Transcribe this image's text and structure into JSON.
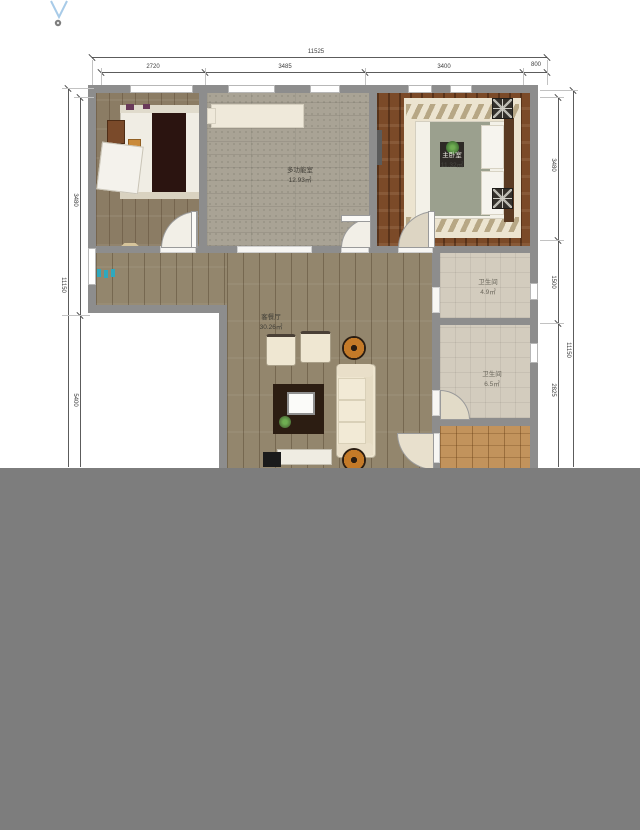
{
  "dimensions": {
    "top": {
      "total": "11525",
      "segments": [
        "2720",
        "3485",
        "3400",
        "800"
      ]
    },
    "left": {
      "total": "11150",
      "segments": [
        "3480",
        "5400"
      ]
    },
    "right": {
      "total": "11150",
      "segments": [
        "3480",
        "1500",
        "2825"
      ]
    }
  },
  "rooms": {
    "multi": {
      "name": "多功能室",
      "area": "12.93㎡"
    },
    "master": {
      "name": "主卧室",
      "area": "11.32㎡"
    },
    "living": {
      "name": "客餐厅",
      "area": "30.26㎡"
    },
    "bath1": {
      "name": "卫生间",
      "area": "4.9㎡"
    },
    "bath2": {
      "name": "卫生间",
      "area": "6.5㎡"
    }
  },
  "icons": {
    "north_arrow": "north-arrow",
    "entry_marker": "entry-marker",
    "bedside_lamps": "lamp-starburst",
    "plants": "potted-plant"
  },
  "palette": {
    "wall": "#8d8d8d",
    "overlay_gray": "#7d7d7d",
    "north_arrow_blue": "#a8cbe8",
    "entry_marker_teal": "#2fa8bd",
    "master_floor": "#7b4a28",
    "living_floor": "#93866d",
    "tatami_floor": "#a9a395",
    "bath_floor": "#d3ccbe",
    "kitchen_floor": "#c2935c"
  }
}
